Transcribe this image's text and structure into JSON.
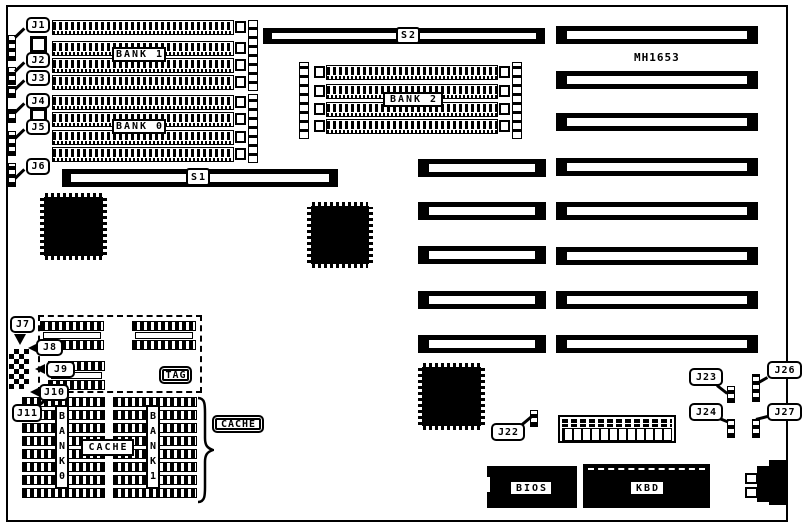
{
  "board": {
    "model_label": "MH1653"
  },
  "memory": {
    "bank1_label": "BANK 1",
    "bank0_label": "BANK 0",
    "bank2_label": "BANK 2"
  },
  "slots": {
    "s1_label": "S1",
    "s2_label": "S2"
  },
  "jumper_labels": {
    "j1": "J1",
    "j2": "J2",
    "j3": "J3",
    "j4": "J4",
    "j5": "J5",
    "j6": "J6",
    "j7": "J7",
    "j8": "J8",
    "j9": "J9",
    "j10": "J10",
    "j11": "J11",
    "j22": "J22",
    "j23": "J23",
    "j24": "J24",
    "j26": "J26",
    "j27": "J27"
  },
  "cache": {
    "tag_label": "TAG",
    "cache_label": "CACHE",
    "cache_callout_label": "CACHE",
    "bank0_vertical_label": "BANK0",
    "bank1_vertical_label": "BANK1"
  },
  "chips": {
    "bios_label": "BIOS",
    "kbd_label": "KBD"
  }
}
